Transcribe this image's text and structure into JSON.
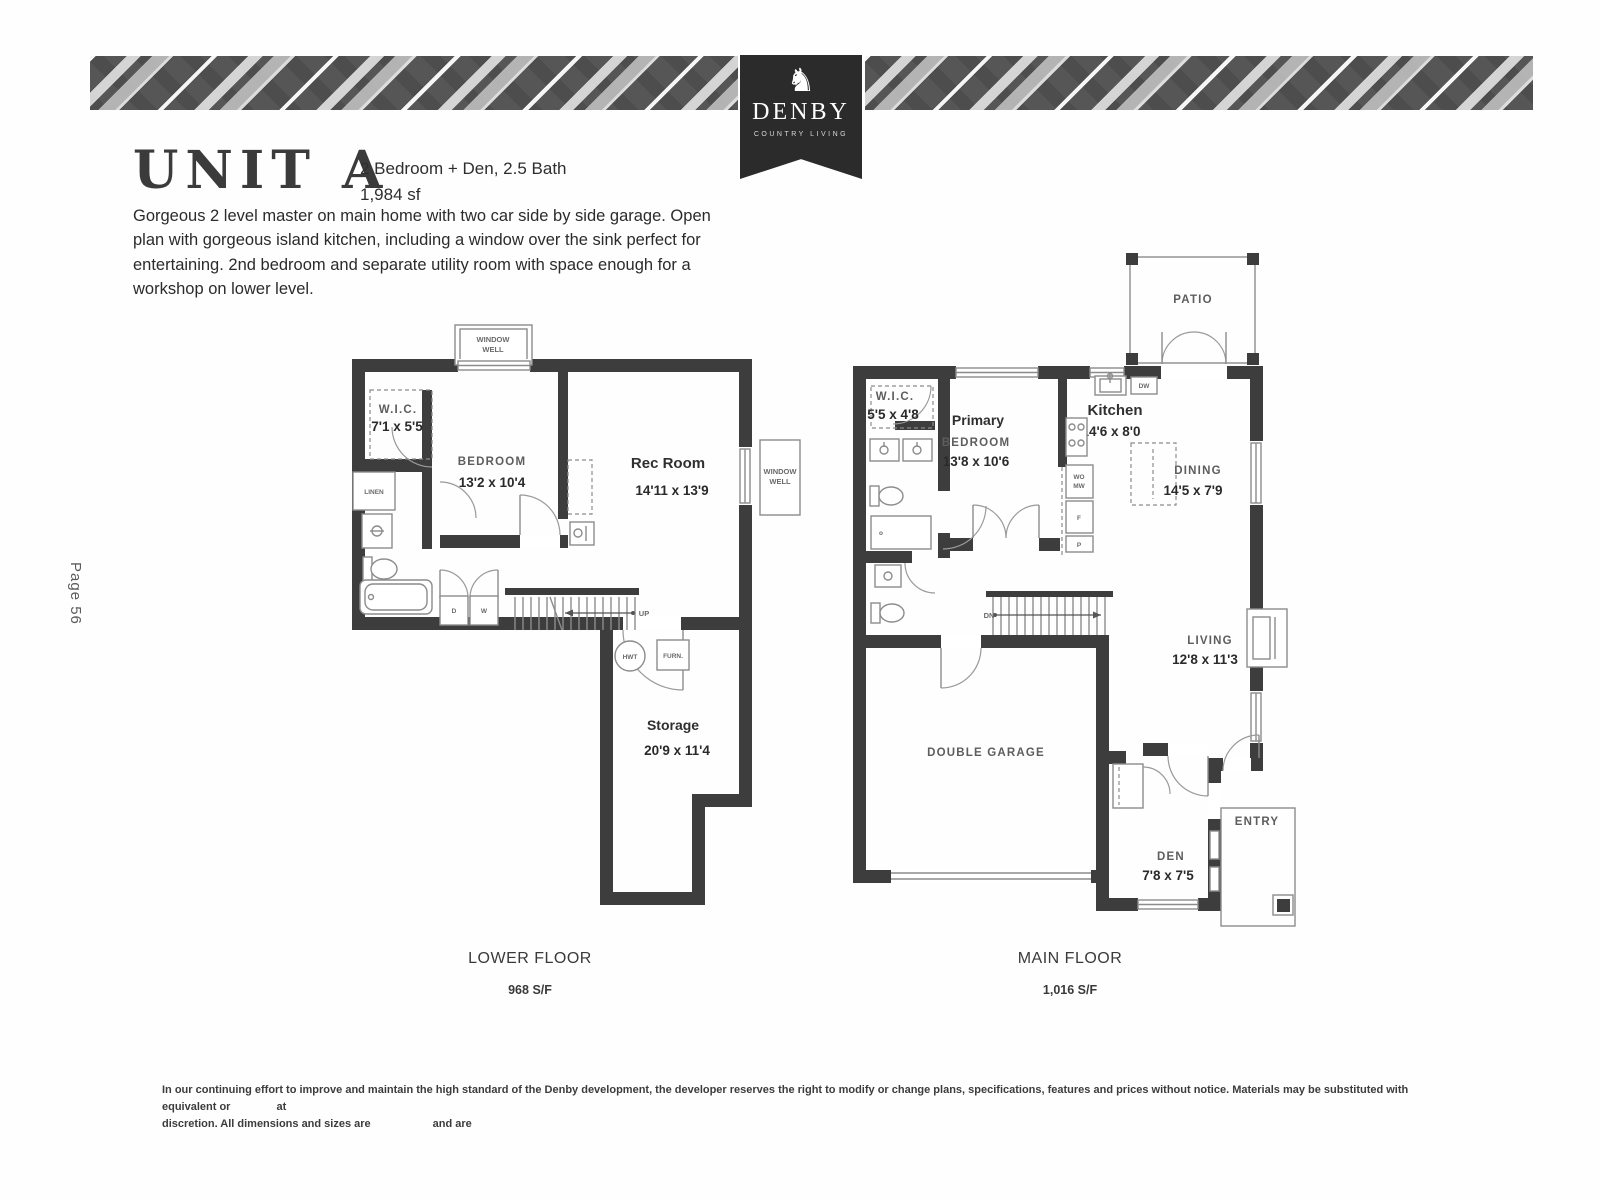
{
  "page": {
    "page_number": "Page 56"
  },
  "brand": {
    "name": "DENBY",
    "tagline": "COUNTRY LIVING",
    "logo_glyph": "♞",
    "ribbon_color": "#2b2b2b"
  },
  "header": {
    "title": "UNIT A",
    "spec_line1": "2 Bedroom + Den, 2.5 Bath",
    "spec_line2": "1,984 sf",
    "description": "Gorgeous 2 level master on main home with two car side by side garage. Open plan with gorgeous island kitchen, including a window over the sink perfect for entertaining. 2nd bedroom and separate utility room with space enough for a workshop on lower level."
  },
  "lower_floor": {
    "caption": "LOWER FLOOR",
    "area": "968 S/F",
    "rooms": {
      "wic": {
        "name": "W.I.C.",
        "dims": "7'1 x 5'5"
      },
      "bedroom": {
        "name": "BEDROOM",
        "dims": "13'2 x 10'4"
      },
      "rec": {
        "name": "Rec Room",
        "dims": "14'11 x 13'9"
      },
      "storage": {
        "name": "Storage",
        "dims": "20'9 x 11'4"
      }
    },
    "labels": {
      "window_well_l1": "WINDOW",
      "window_well_l2": "WELL",
      "linen": "LINEN",
      "up": "UP",
      "hwt": "HWT",
      "furn": "FURN.",
      "dryer": "D",
      "washer": "W"
    }
  },
  "main_floor": {
    "caption": "MAIN FLOOR",
    "area": "1,016 S/F",
    "rooms": {
      "patio": {
        "name": "PATIO"
      },
      "wic": {
        "name": "W.I.C.",
        "dims": "5'5 x 4'8"
      },
      "primary": {
        "name": "Primary",
        "name2": "BEDROOM",
        "dims": "13'8 x 10'6"
      },
      "kitchen": {
        "name": "Kitchen",
        "dims": "14'6 x 8'0"
      },
      "dining": {
        "name": "DINING",
        "dims": "14'5 x 7'9"
      },
      "living": {
        "name": "LIVING",
        "dims": "12'8 x 11'3"
      },
      "garage": {
        "name": "DOUBLE GARAGE"
      },
      "den": {
        "name": "DEN",
        "dims": "7'8 x 7'5"
      },
      "entry": {
        "name": "ENTRY"
      }
    },
    "labels": {
      "dn": "DN",
      "dw": "DW",
      "wall_oven": "WO",
      "microwave": "MW",
      "fridge": "F",
      "pantry": "P",
      "shower": "o"
    }
  },
  "footer": {
    "line1_a": "In our continuing effort to improve and maintain the high standard of the Denby development, the developer reserves the right to modify or change plans, specifications, features and prices without notice. Materials may be substituted with equivalent or",
    "line1_b": "at",
    "line2_a": "discretion. All dimensions and sizes are",
    "line2_b": "and are"
  }
}
